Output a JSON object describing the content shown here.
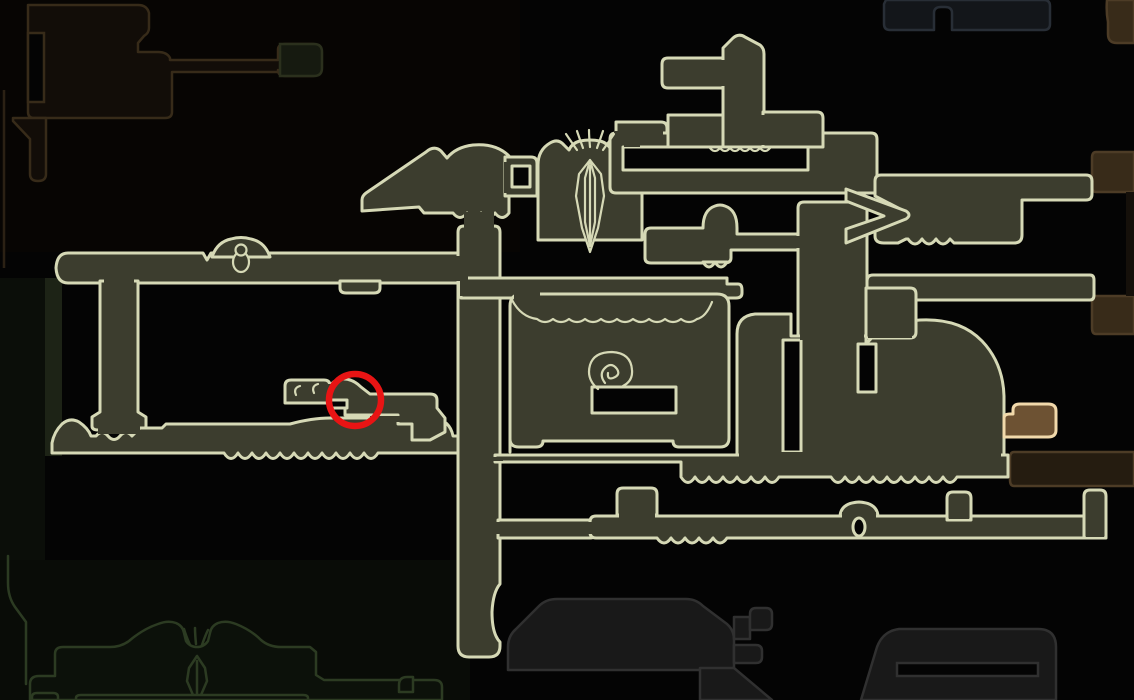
{
  "app": {
    "name": "game-map-screen",
    "description": "In-game world map screen: explored olive rooms with pale outlines on a black background, adjacent unexplored zones dimmed in brown, navy, gray and green, one room highlighted in orange, and a red circle drawn around a target location."
  },
  "canvas": {
    "width": 1134,
    "height": 700
  },
  "colors": {
    "bg": "#040404",
    "room_fill": "#3c3d2e",
    "room_stroke": "#d6d9b6",
    "marker_red": "#e81414",
    "highlight_room_fill": "#6d5233",
    "highlight_room_stroke": "#f1d9ab",
    "zone_brown_fill": "#382b19",
    "zone_brown_stroke": "#4d3c26",
    "zone_brown_dark_fill": "#251c10",
    "zone_building_fill": "#120d08",
    "zone_building_stroke": "#372b19",
    "zone_navy_fill": "#13161a",
    "zone_navy_stroke": "#282e36",
    "zone_gray_fill": "#191919",
    "zone_gray_stroke": "#303030",
    "zone_green_fill": "#0c110a",
    "zone_green_stroke": "#2c3b22",
    "panel_topleft": "#070503",
    "panel_bottomleft": "#090c07",
    "strip_green": "#1d2316"
  },
  "marker": {
    "shape": "circle",
    "x": 355,
    "y": 400,
    "radius": 26,
    "stroke_width": 6.5,
    "meaning": "red circle drawn around a map location"
  },
  "highlight_room": {
    "x": 1004,
    "y": 404,
    "width": 52,
    "height": 33,
    "meaning": "orange highlighted room at right edge of explored map"
  },
  "regions": [
    {
      "name": "explored-map",
      "style": "olive rooms with cream outlines",
      "bounds": [
        45,
        120,
        1110,
        545
      ]
    },
    {
      "name": "settlement-silhouette-top-left",
      "style": "dark brown outline",
      "bounds": [
        10,
        0,
        325,
        185
      ]
    },
    {
      "name": "dark-room-top",
      "style": "dark navy outline",
      "bounds": [
        884,
        0,
        1050,
        30
      ]
    },
    {
      "name": "brown-zone-right",
      "style": "dark brown blocks along right edge",
      "bounds": [
        1010,
        0,
        1134,
        490
      ]
    },
    {
      "name": "green-zone-bottom-left",
      "style": "dark green skyline with mini emblem",
      "bounds": [
        0,
        555,
        445,
        700
      ]
    },
    {
      "name": "gray-zone-bottom-center",
      "style": "dark gray mounds and corridors",
      "bounds": [
        495,
        590,
        1075,
        700
      ]
    }
  ],
  "decorations": [
    {
      "name": "temple-emblem",
      "x": 590,
      "y": 200,
      "style": "faceted spire glyph with whiskers above"
    },
    {
      "name": "egg-ornament",
      "x": 241,
      "y": 255,
      "style": "egg in arch on corridor top edge"
    },
    {
      "name": "spiral-ornament",
      "x": 611,
      "y": 370,
      "style": "snail spiral glyph in center room"
    },
    {
      "name": "arch-door",
      "x": 859,
      "y": 527,
      "style": "oval doorway in lower corridor bump"
    },
    {
      "name": "mini-emblem",
      "x": 197,
      "y": 678,
      "style": "small spire glyph in green zone"
    },
    {
      "name": "claw-marks",
      "x": 308,
      "y": 389,
      "style": "two small arcs inside circled room"
    }
  ]
}
